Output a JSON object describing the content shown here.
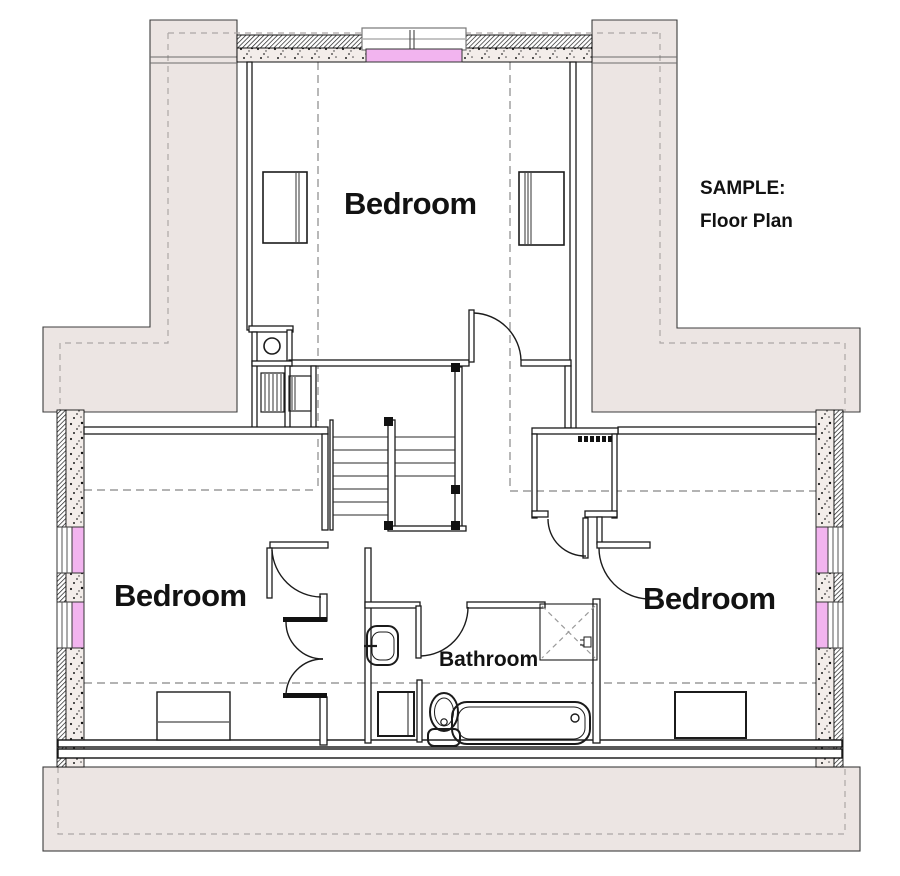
{
  "page": {
    "title": "SAMPLE: Floor Plan"
  },
  "annotation": {
    "line1": "SAMPLE:",
    "line2": "Floor Plan"
  },
  "rooms": {
    "bedroom_top": "Bedroom",
    "bedroom_left": "Bedroom",
    "bedroom_right": "Bedroom",
    "bathroom": "Bathroom"
  },
  "fixtures": [
    "stairs",
    "bathtub",
    "toilet",
    "wall-sink",
    "shower-dashed-x",
    "vanity-cabinet",
    "closet-with-shelf",
    "double-door",
    "swing-door",
    "dresser",
    "desk",
    "utility-basin"
  ],
  "colors": {
    "window_pink": "#F2B4EF",
    "roof_shade": "#ECE5E3",
    "wall": "#1b1b1b",
    "dashed": "#9a9a9a",
    "text": "#121212"
  }
}
